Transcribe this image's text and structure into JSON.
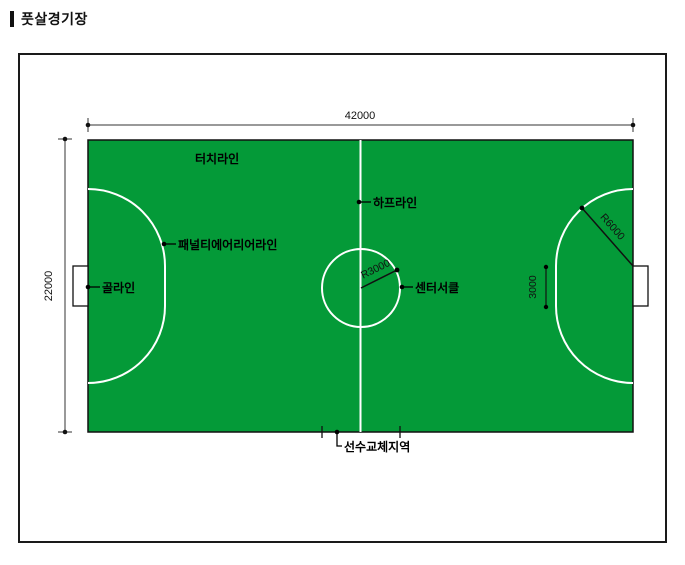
{
  "page": {
    "title": "풋살경기장"
  },
  "diagram": {
    "type": "futsal-field-plan",
    "field_fill_color": "#049A38",
    "field_line_color": "#FFFFFF",
    "outline_color": "#1A1A1A"
  },
  "dims": {
    "width": "42000",
    "height": "22000",
    "straight": "3000",
    "penalty_radius": "R6000",
    "center_radius": "R3000"
  },
  "labels": {
    "touchline": "터치라인",
    "half_line": "하프라인",
    "penalty_area_line": "패널티에어리어라인",
    "goal_line": "골라인",
    "center_circle": "센터서클",
    "substitution_zone": "선수교체지역"
  }
}
